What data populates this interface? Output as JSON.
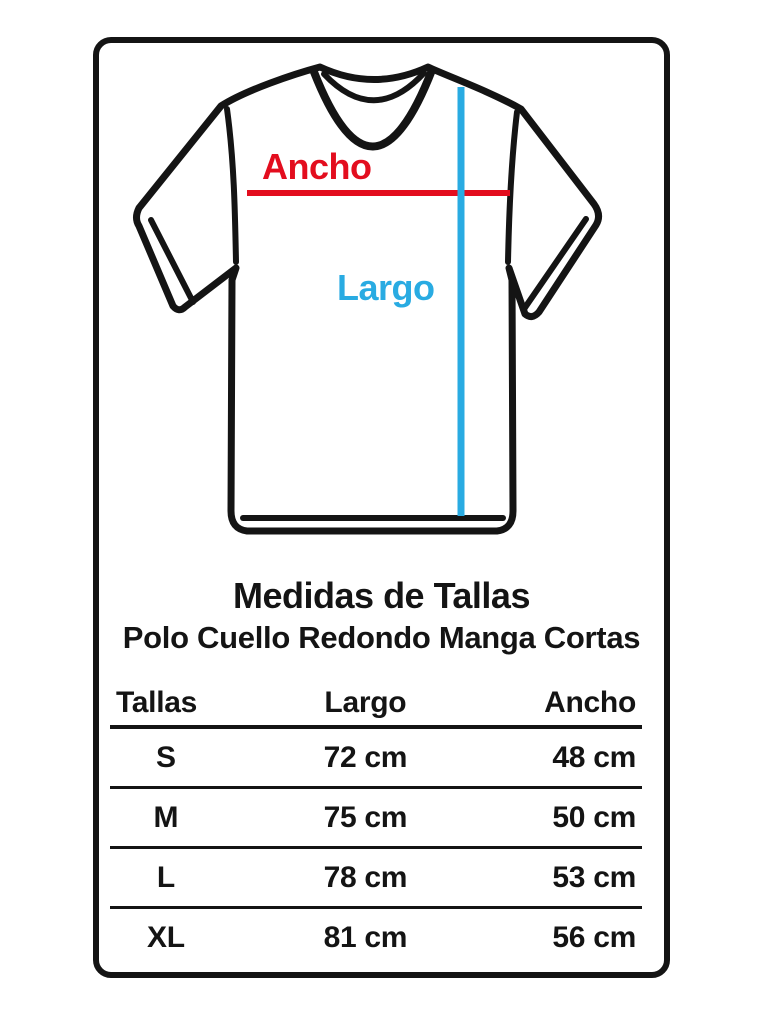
{
  "document": {
    "background": "#ffffff",
    "ink_color": "#141414"
  },
  "shirt_diagram": {
    "width_label": "Ancho",
    "length_label": "Largo",
    "width_line_color": "#e30d1e",
    "length_line_color": "#29abe2"
  },
  "heading": {
    "title": "Medidas de Tallas",
    "subtitle": "Polo Cuello Redondo Manga Cortas"
  },
  "size_table": {
    "headers": {
      "size": "Tallas",
      "length": "Largo",
      "width": "Ancho"
    },
    "rows": [
      {
        "size": "S",
        "length": "72 cm",
        "width": "48 cm"
      },
      {
        "size": "M",
        "length": "75 cm",
        "width": "50 cm"
      },
      {
        "size": "L",
        "length": "78 cm",
        "width": "53 cm"
      },
      {
        "size": "XL",
        "length": "81 cm",
        "width": "56 cm"
      }
    ]
  },
  "chart_data": {
    "type": "table",
    "title": "Medidas de Tallas",
    "subtitle": "Polo Cuello Redondo Manga Cortas",
    "columns": [
      "Tallas",
      "Largo",
      "Ancho"
    ],
    "rows": [
      [
        "S",
        "72 cm",
        "48 cm"
      ],
      [
        "M",
        "75 cm",
        "50 cm"
      ],
      [
        "L",
        "78 cm",
        "53 cm"
      ],
      [
        "XL",
        "81 cm",
        "56 cm"
      ]
    ],
    "units": "cm"
  }
}
